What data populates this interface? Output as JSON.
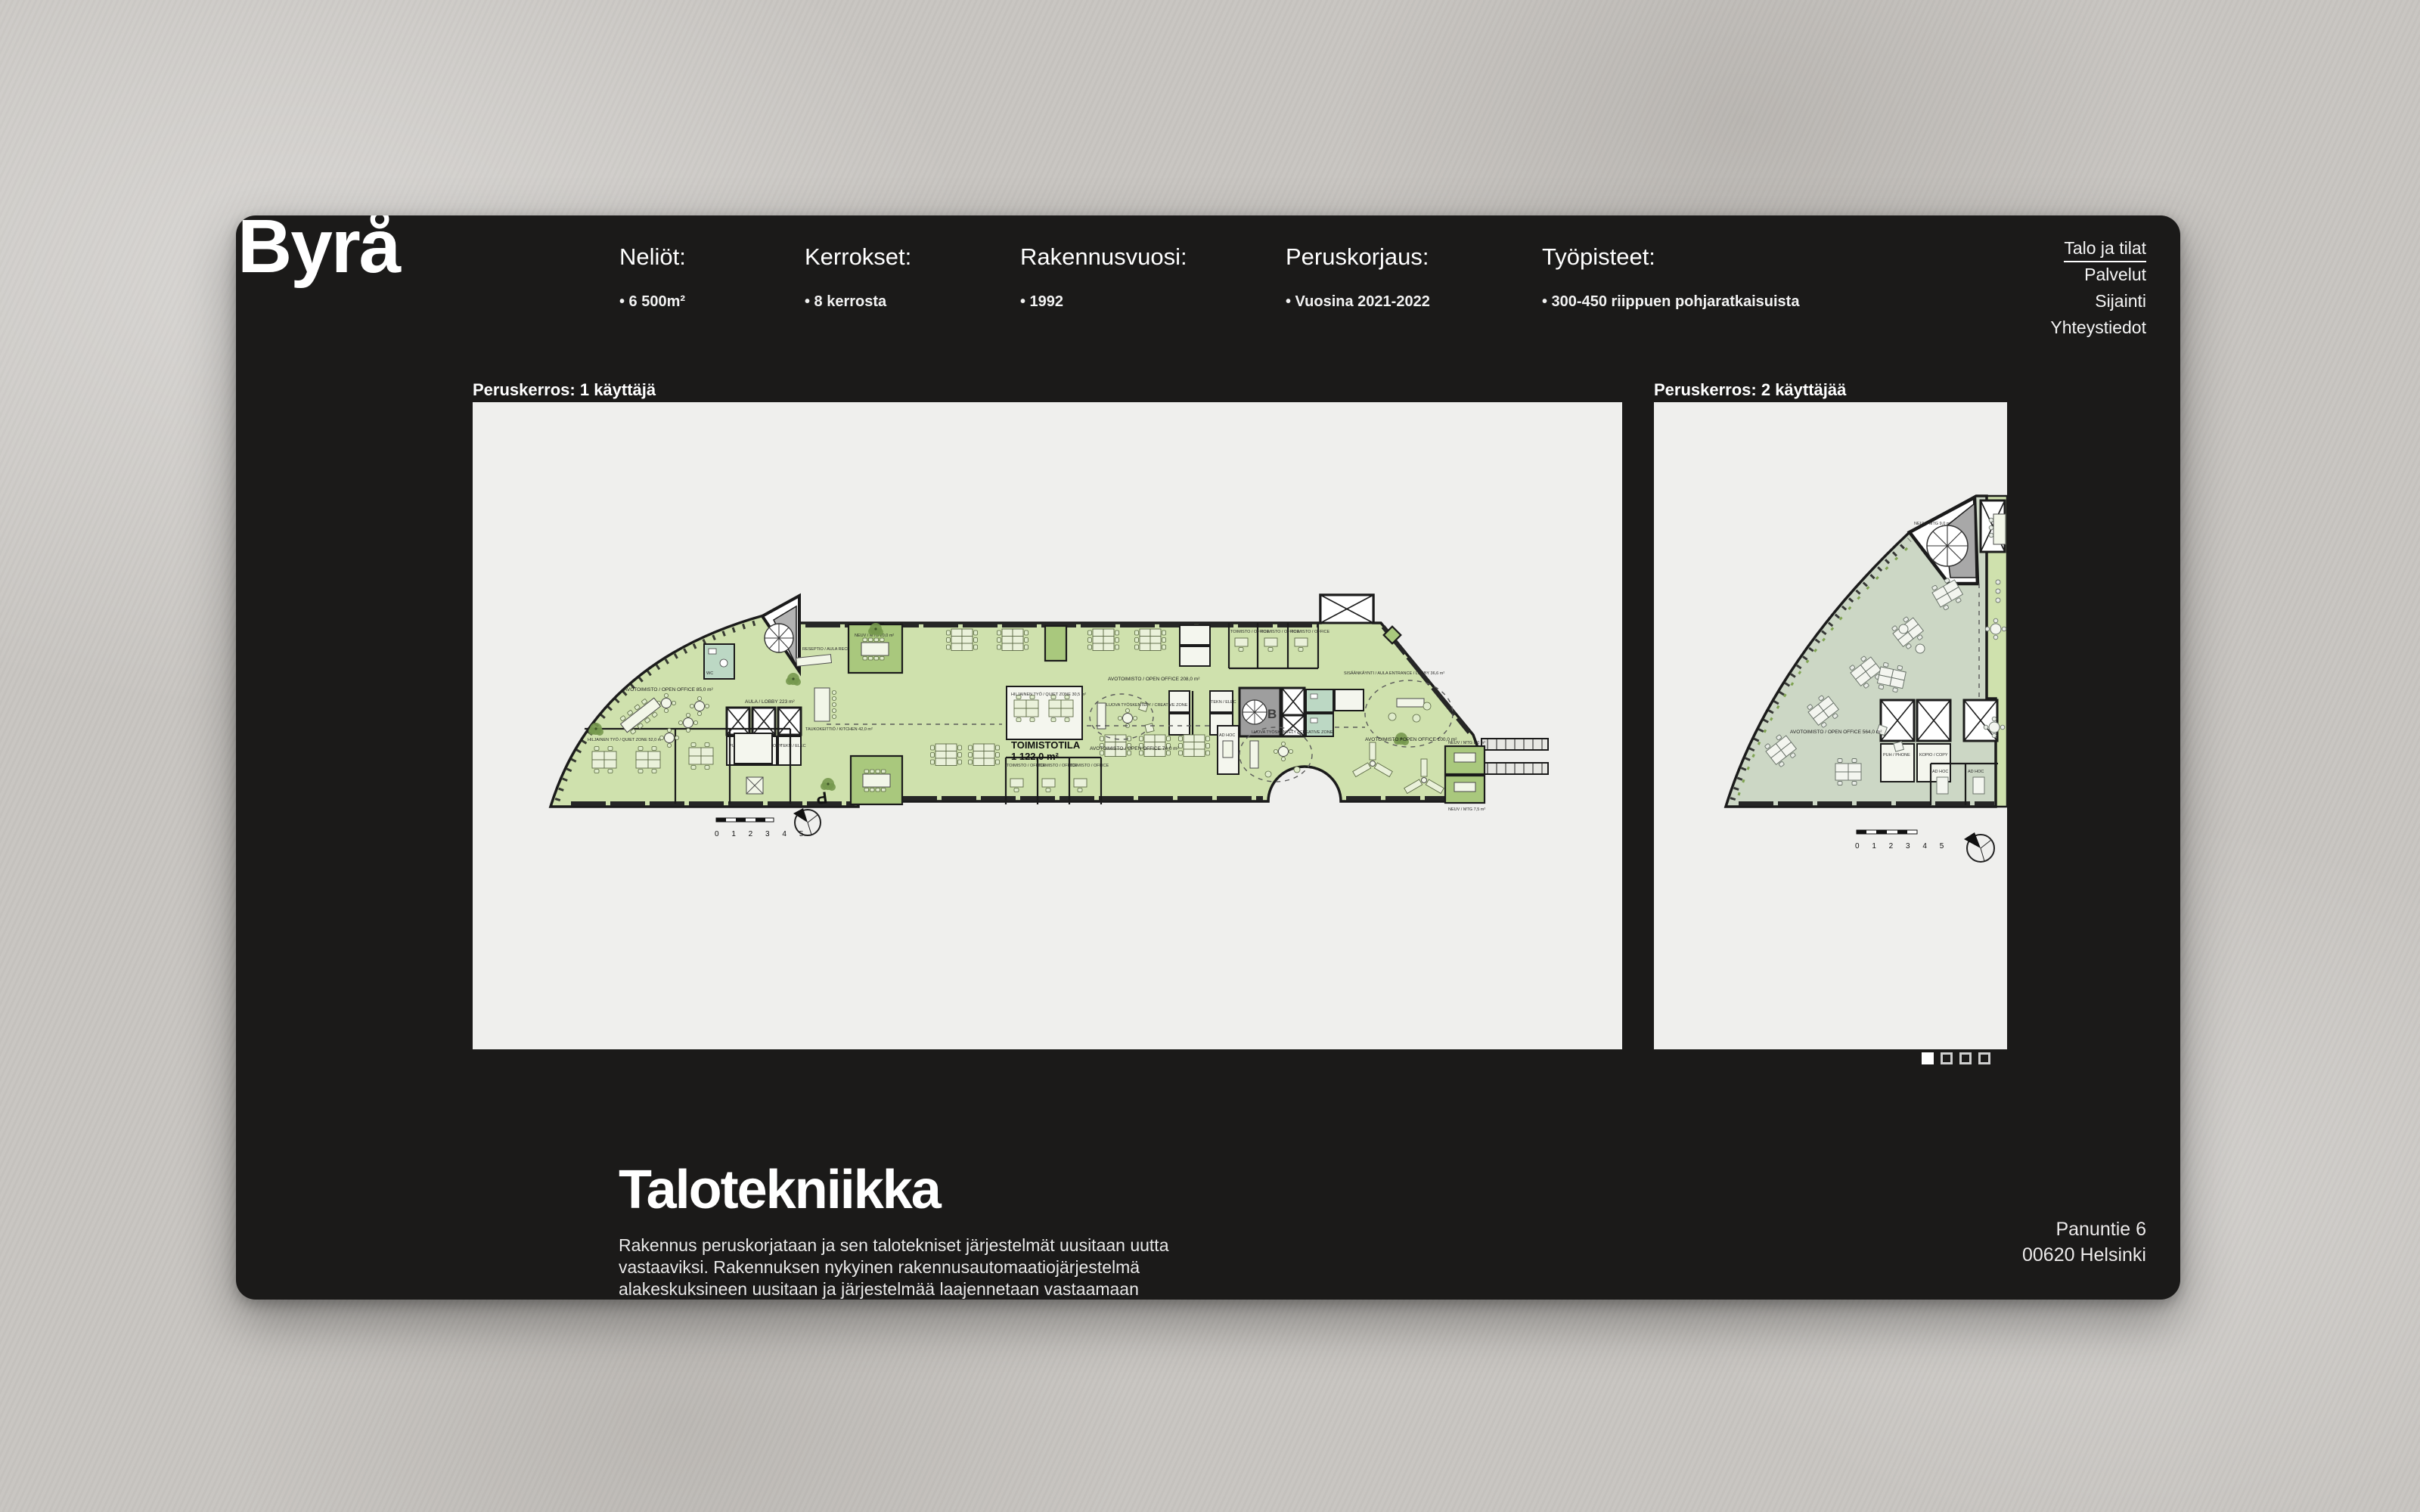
{
  "brand": {
    "logo": "Byrå"
  },
  "colors": {
    "card_bg": "#1b1a19",
    "panel_bg": "#efefed",
    "plan_green": "#cfe1ad",
    "plan_green_dark": "#a9c87d",
    "plan_sage": "#ccd7c5",
    "text": "#ffffff"
  },
  "stats": [
    {
      "label": "Neliöt:",
      "value": "• 6 500m²"
    },
    {
      "label": "Kerrokset:",
      "value": "• 8 kerrosta"
    },
    {
      "label": "Rakennusvuosi:",
      "value": "• 1992"
    },
    {
      "label": "Peruskorjaus:",
      "value": "• Vuosina 2021-2022"
    },
    {
      "label": "Työpisteet:",
      "value": "• 300-450 riippuen pohjaratkaisuista"
    }
  ],
  "nav": {
    "items": [
      {
        "label": "Talo ja tilat",
        "active": true
      },
      {
        "label": "Palvelut",
        "active": false
      },
      {
        "label": "Sijainti",
        "active": false
      },
      {
        "label": "Yhteystiedot",
        "active": false
      }
    ]
  },
  "carousel": {
    "captions": {
      "left": "Peruskerros: 1 käyttäjä",
      "right": "Peruskerros: 2 käyttäjää"
    },
    "page_count": 4,
    "active_page": 1
  },
  "plan_labels": {
    "toimistotila": "TOIMISTOTILA",
    "toimistotila_area": "1 122,0 m²",
    "open_office_208": "AVOTOIMISTO / OPEN OFFICE 208,0 m²",
    "open_office_74": "AVOTOIMISTO / OPEN OFFICE 74,0 m²",
    "open_office_100": "AVOTOIMISTO / OPEN OFFICE 100,0 m²",
    "open_office_85": "AVOTOIMISTO / OPEN OFFICE 85,0 m²",
    "open_office_564": "AVOTOIMISTO / OPEN OFFICE 564,0 m²",
    "quiet_52": "HILJAINEN TYÖ / QUIET ZONE 52,0 m²",
    "quiet_30": "HILJAINEN TYÖ / QUIET ZONE 30,5 m²",
    "creative": "LUOVA TYÖSKENTELY / CREATIVE ZONE",
    "reception": "RESEPTIO / AULA RECEPTION / LOBBY",
    "lobby": "AULA / LOBBY 223 m²",
    "kitchen": "TAUKOKEITTIÖ / KITCHEN 42,0 m²",
    "entrance": "SISÄÄNKÄYNTI / AULA ENTRANCE / LOBBY 36,6 m²",
    "office": "TOIMISTO / OFFICE",
    "meeting_8": "NEUV / MTG 8,0 m²",
    "meeting_7": "NEUV / MTG 7,5 m²",
    "meeting_20": "NEUV / MTG 20,0 m²",
    "meeting_9": "NEUV / MTG 9,0 m²",
    "adhoc": "AD HOC",
    "phone": "PUH / PHONE",
    "copy": "KOPIO / COPY",
    "tekn": "TEKN / ELEC",
    "wc": "WC",
    "stair_b": "B",
    "parking": "P",
    "scale": "0 1 2 3 4 5"
  },
  "section": {
    "title": "Talotekniikka",
    "paragraph": "Rakennus peruskorjataan ja sen talotekniset järjestelmät uusitaan uutta vastaaviksi. Rakennuksen nykyinen rakennusautomaatiojärjestelmä alakeskuksineen uusitaan ja järjestelmää laajennetaan vastaamaan saneerauksen vaatimuksia."
  },
  "address": {
    "line1": "Panuntie 6",
    "line2": "00620 Helsinki"
  }
}
